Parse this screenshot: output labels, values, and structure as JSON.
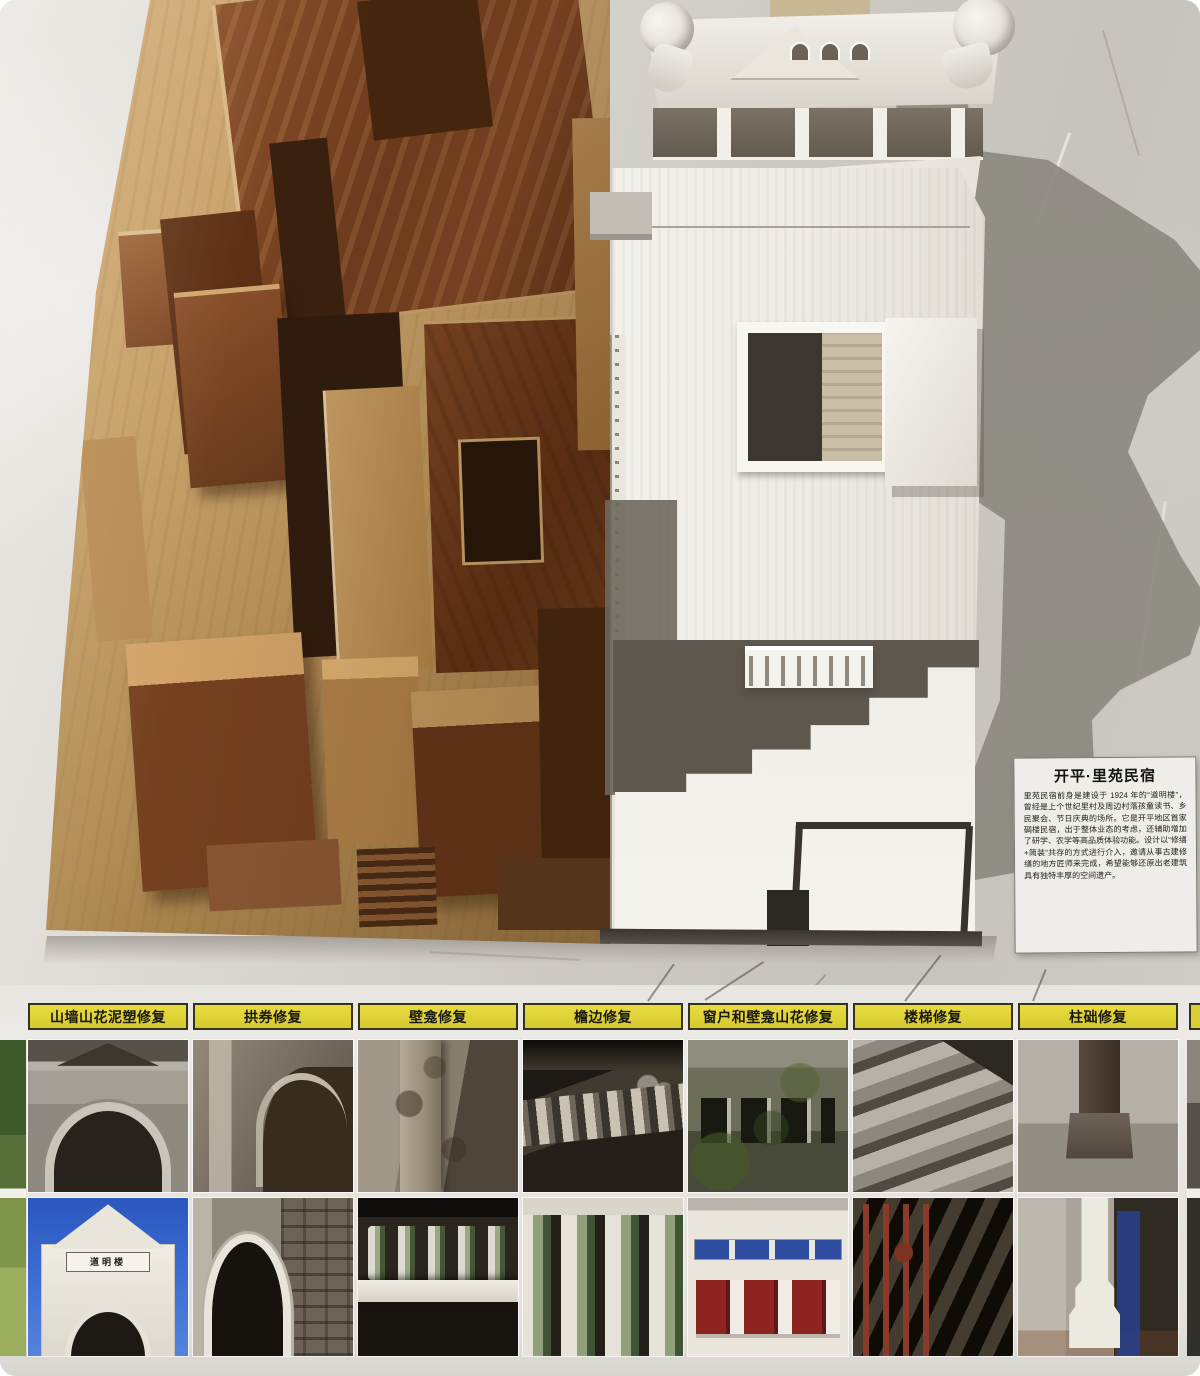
{
  "info_card": {
    "title": "开平·里苑民宿",
    "body": "里苑民宿前身是建设于 1924 年的“道明楼”，曾经是上个世纪里村及周边村落孩童读书、乡民聚会、节日庆典的场所。它是开平地区首家碉楼民宿，出于整体业态的考虑，还辅助增加了研学、农学等高品质体验功能。设计以“修缮+简装”共存的方式进行介入，邀请从事古建修缮的地方匠师来完成，希望能够还原出老建筑具有独特丰厚的空间遗产。"
  },
  "figures": {
    "left_model": "wooden massing model of the guesthouse",
    "right_model": "white facade model of the Daoming diaolou with cast shadow"
  },
  "restoration_board": {
    "gate_plaque_text": "道明楼",
    "label_color": "#d9cd33",
    "columns": [
      {
        "label": "山墙山花泥塑修复",
        "before": "weathered gatehouse pediment and arch",
        "after": "restored white gatehouse under blue sky"
      },
      {
        "label": "拱券修复",
        "before": "ruined arch with eroded plaster",
        "after": "restored arch with brick wall and white columns"
      },
      {
        "label": "壁龛修复",
        "before": "eroded masonry niche column",
        "after": "restored niche shelf with ceramic balusters"
      },
      {
        "label": "檐边修复",
        "before": "decayed eave with old balustrade and pots",
        "after": "restored green glazed balusters"
      },
      {
        "label": "窗户和壁龛山花修复",
        "before": "moss-covered facade with windows",
        "after": "restored white facade with red shuttered windows"
      },
      {
        "label": "楼梯修复",
        "before": "worn concrete steps",
        "after": "restored timber staircase with red railing"
      },
      {
        "label": "柱础修复",
        "before": "damaged column base",
        "after": "restored column base on stepped plinth"
      }
    ]
  },
  "colors": {
    "wall": "#cdc9c3",
    "wood_light": "#c49e66",
    "wood_dark": "#6f3c1e",
    "model_white": "#f3f1eb",
    "shadow": "#8d8982",
    "sky_blue": "#3e6fd4"
  }
}
